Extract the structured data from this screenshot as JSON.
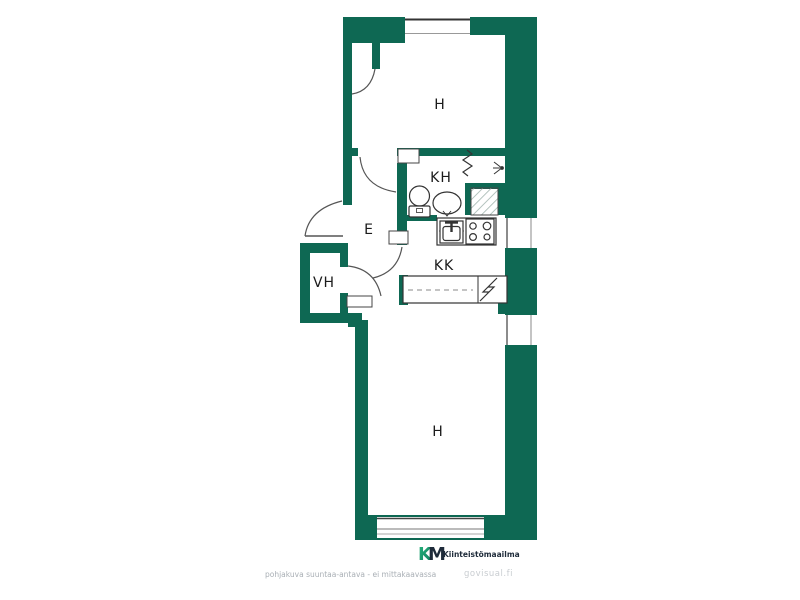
{
  "floorplan": {
    "type": "apartment floor plan",
    "rooms": [
      {
        "id": "h-top",
        "label": "H"
      },
      {
        "id": "kh",
        "label": "KH"
      },
      {
        "id": "e",
        "label": "E"
      },
      {
        "id": "vh",
        "label": "VH"
      },
      {
        "id": "kk",
        "label": "KK"
      },
      {
        "id": "h-bottom",
        "label": "H"
      }
    ],
    "fixtures": [
      "toilet",
      "washbasin",
      "shower",
      "kitchen-sink",
      "stove",
      "counter",
      "electrical-panel",
      "radiator",
      "shower-head"
    ],
    "windows": [
      "top-wall-window",
      "right-wall-kitchen-window",
      "right-wall-lower-window",
      "bottom-wall-window"
    ]
  },
  "footer": {
    "disclaimer": "pohjakuva suuntaa-antava - ei mittakaavassa",
    "watermark": "govisual.fi"
  },
  "logo": {
    "k": "K",
    "m": "M",
    "brand": "Kiinteistömaailma"
  },
  "colors": {
    "wall_green": "#0e6853",
    "logo_green": "#1fa873",
    "logo_navy": "#1e2b3a",
    "fixture_line": "#333333",
    "disclaimer_gray": "#a9afb5",
    "watermark_gray": "#c9cdd1",
    "background": "#ffffff"
  }
}
